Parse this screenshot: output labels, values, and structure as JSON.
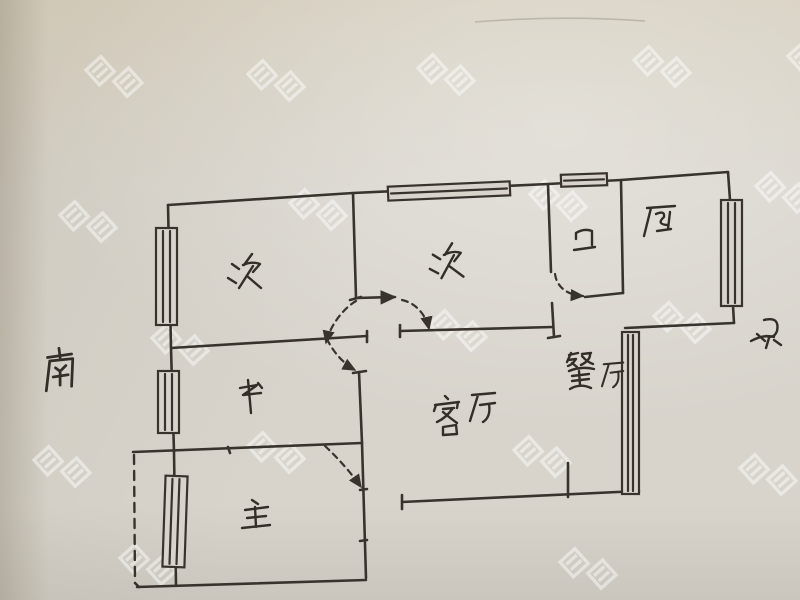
{
  "floor_plan": {
    "rooms": [
      {
        "id": "secondary-bedroom-left",
        "label": "次"
      },
      {
        "id": "secondary-bedroom-middle",
        "label": "次"
      },
      {
        "id": "bathroom",
        "label": "卫"
      },
      {
        "id": "kitchen",
        "label": "厨"
      },
      {
        "id": "study",
        "label": "书"
      },
      {
        "id": "living-room",
        "label": "客厅"
      },
      {
        "id": "dining-room",
        "label": "餐厅"
      },
      {
        "id": "master-bedroom",
        "label": "主"
      }
    ],
    "compass": {
      "south_label": "南",
      "north_label": "北"
    }
  },
  "watermark": {
    "text": "房星"
  },
  "colors": {
    "paper": "#d8d4cc",
    "ink": "#38332d",
    "watermark_white": "#ffffff"
  }
}
